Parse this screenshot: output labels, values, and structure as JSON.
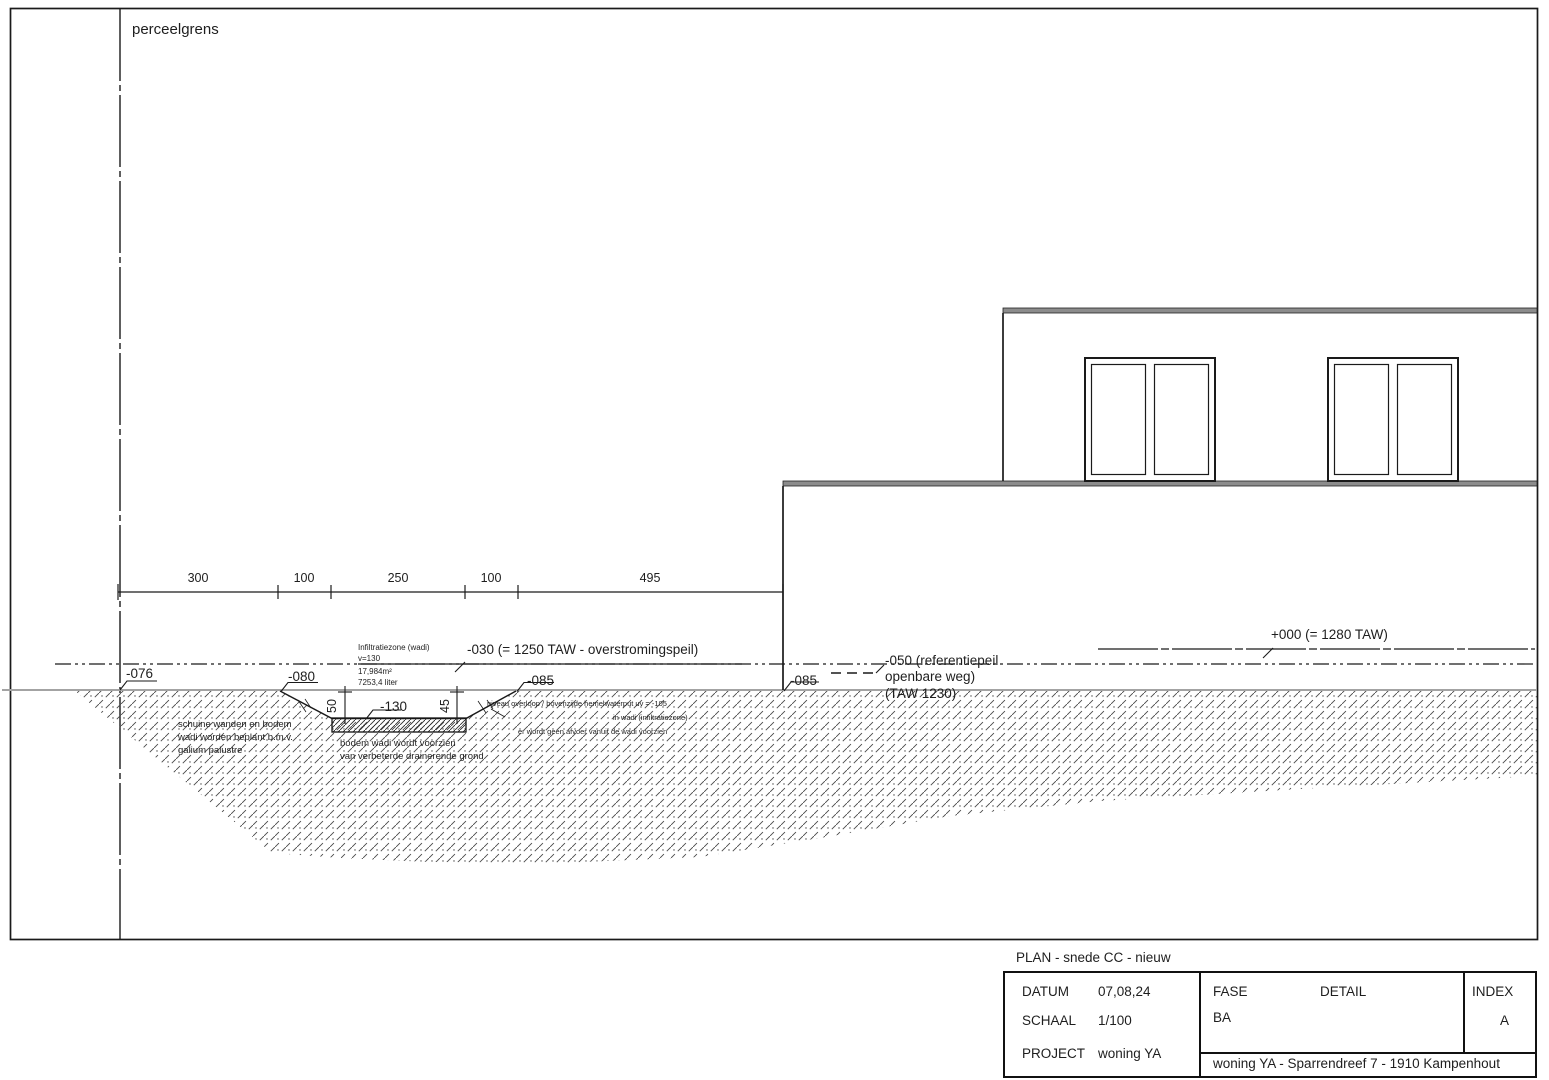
{
  "drawing": {
    "boundary_label": "perceelgrens",
    "dimension_line": {
      "segments": [
        "300",
        "100",
        "250",
        "100",
        "495"
      ]
    },
    "levels": {
      "minus076": "-076",
      "minus080": "-080",
      "minus085_left": "-085",
      "minus085_right": "-085",
      "minus030": "-030 (= 1250 TAW - overstromingspeil)",
      "plus000": "+000 (= 1280 TAW)",
      "minus050_line1": "-050 (referentiepeil",
      "minus050_line2": "openbare weg)",
      "minus050_line3": "(TAW 1230)",
      "minus130": "-130"
    },
    "wadi": {
      "depth_left": "50",
      "depth_right": "45",
      "info_line1": "Infiltratiezone (wadi)",
      "info_line2": "v=130",
      "info_line3": "17,984m²",
      "info_line4": "7253,4 liter",
      "planting_note_line1": "schuine wanden en bodem",
      "planting_note_line2": "wadi worden beplant b.m.v.",
      "planting_note_line3": "galium palustre",
      "bottom_note_line1": "bodem wadi wordt voorzien",
      "bottom_note_line2": "van verbeterde drainerende grond",
      "overflow_note_line1": "niveau overloop / bovenzijde hemelwaterput uv = -105",
      "overflow_note_line2": "in wadi (infiltratiezone)",
      "overflow_note_line3": "er wordt geen afvoer vanuit de wadi voorzien"
    }
  },
  "title_block": {
    "plan_title": "PLAN - snede CC - nieuw",
    "datum_label": "DATUM",
    "datum_value": "07,08,24",
    "schaal_label": "SCHAAL",
    "schaal_value": "1/100",
    "project_label": "PROJECT",
    "project_value": "woning YA",
    "fase_label": "FASE",
    "fase_value": "BA",
    "detail_label": "DETAIL",
    "index_label": "INDEX",
    "index_value": "A",
    "address": "woning YA - Sparrendreef 7 - 1910 Kampenhout"
  }
}
